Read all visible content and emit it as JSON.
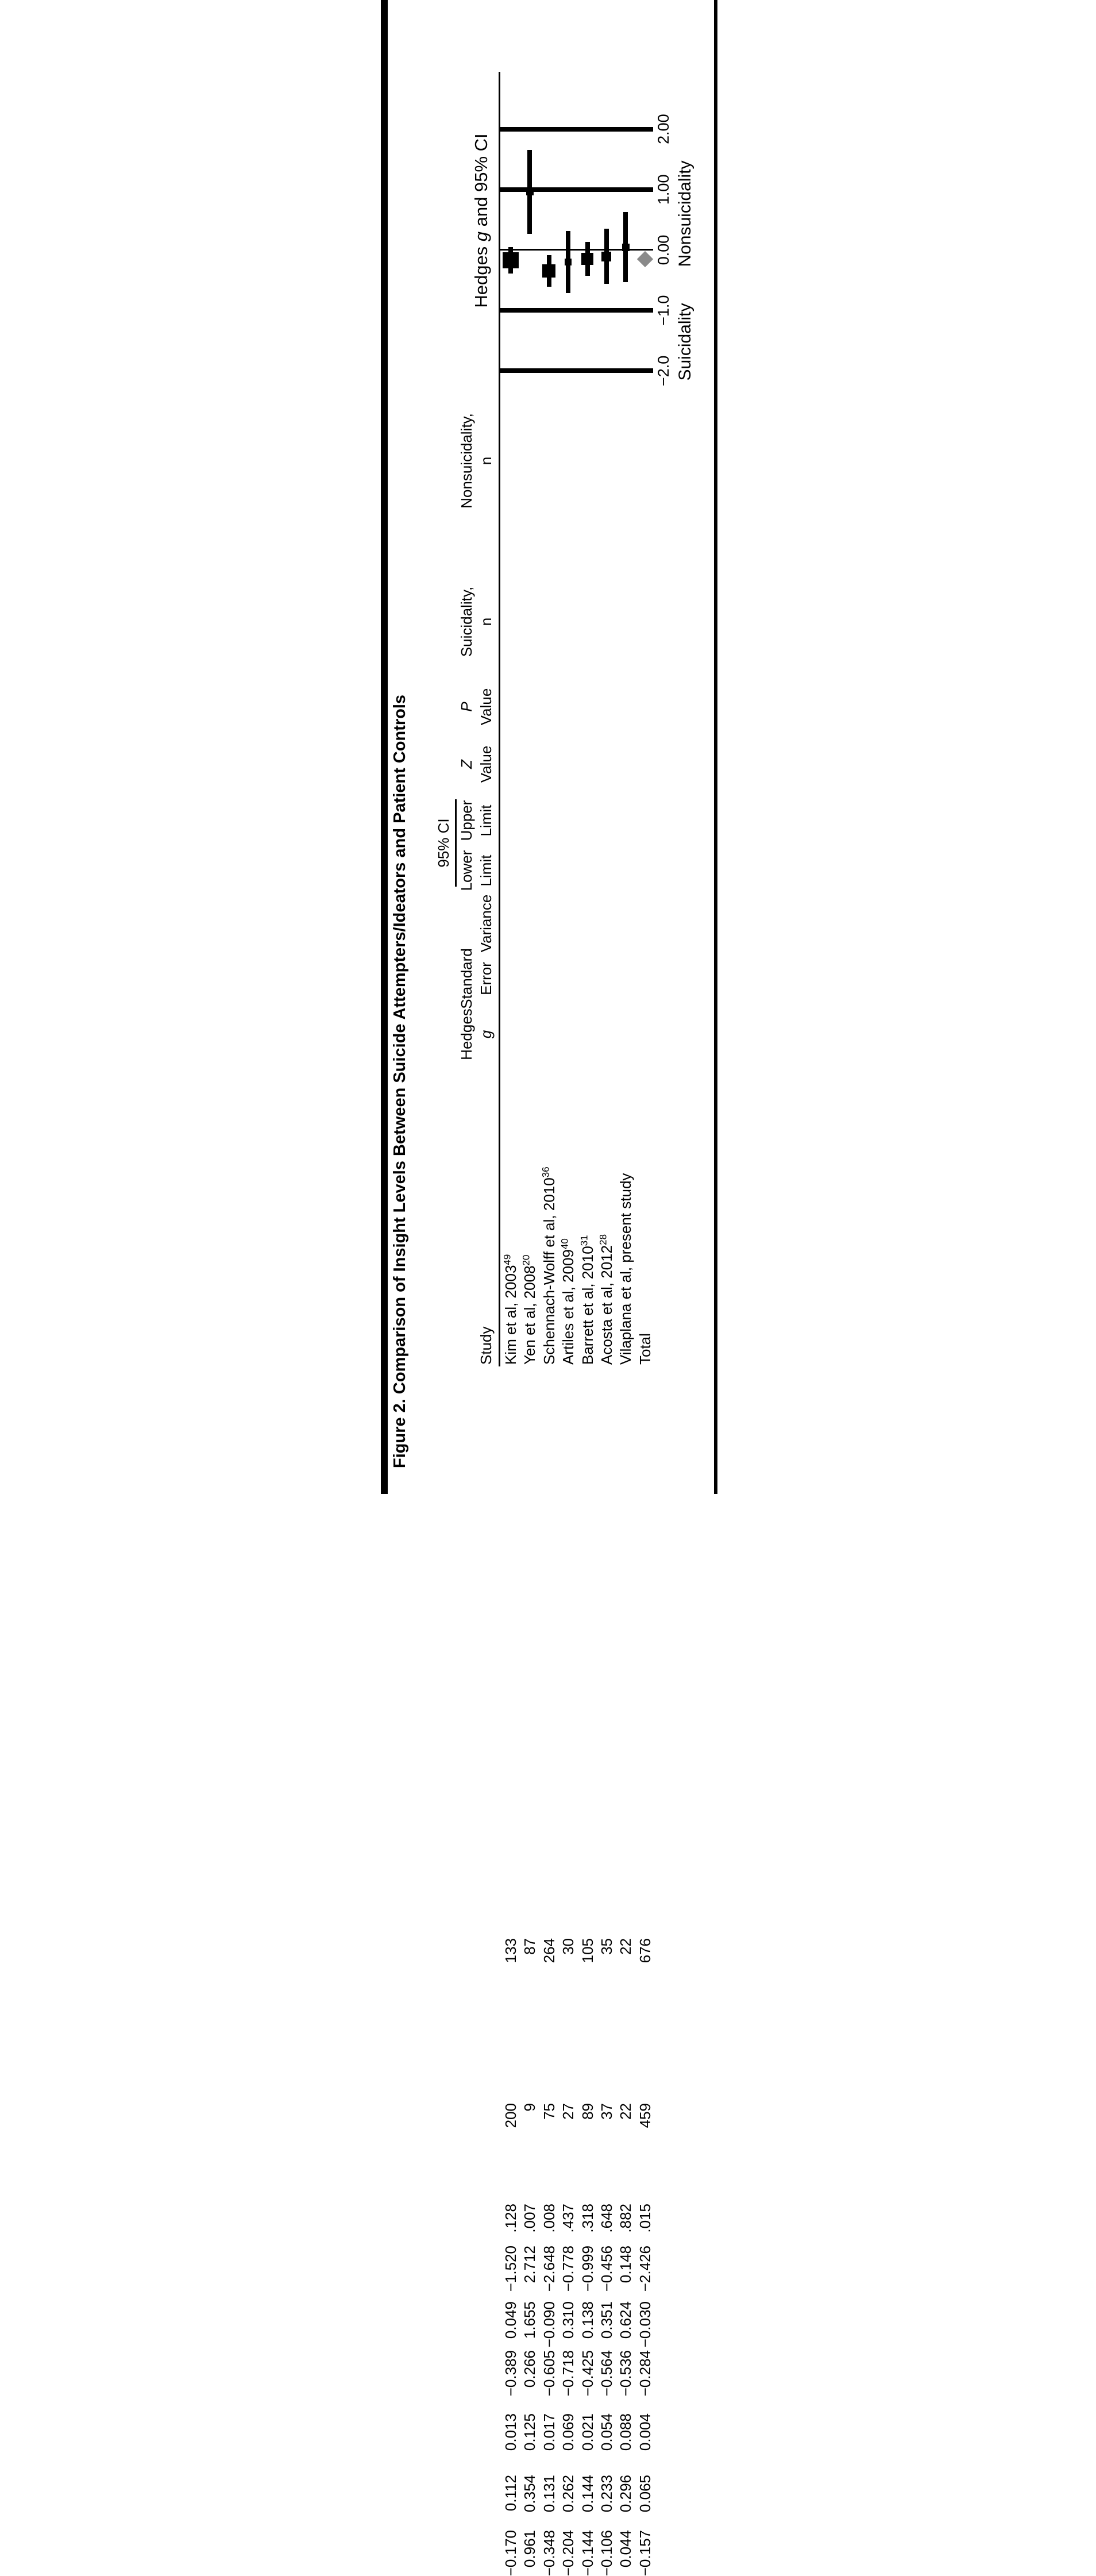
{
  "title": "Figure 2. Comparison of Insight Levels Between Suicide Attempters/Ideators and Patient Controls",
  "table": {
    "ci_spanner": "95% CI",
    "columns": [
      {
        "key": "study",
        "line1": "",
        "line2": "Study"
      },
      {
        "key": "g",
        "line1": "Hedges",
        "line2": "g"
      },
      {
        "key": "se",
        "line1": "Standard",
        "line2": "Error"
      },
      {
        "key": "variance",
        "line1": "",
        "line2": "Variance"
      },
      {
        "key": "lower",
        "line1": "Lower",
        "line2": "Limit"
      },
      {
        "key": "upper",
        "line1": "Upper",
        "line2": "Limit"
      },
      {
        "key": "z",
        "line1": "Z",
        "line2": "Value"
      },
      {
        "key": "p",
        "line1": "P",
        "line2": "Value"
      },
      {
        "key": "suic",
        "line1": "Suicidality,",
        "line2": "n"
      },
      {
        "key": "nonsuic",
        "line1": "Nonsuicidality,",
        "line2": "n"
      }
    ],
    "rows": [
      {
        "study": "Kim et al, 2003",
        "ref": "49",
        "g": "−0.170",
        "se": "0.112",
        "variance": "0.013",
        "lower": "−0.389",
        "upper": "0.049",
        "z": "−1.520",
        "p": ".128",
        "suic": "200",
        "nonsuic": "133"
      },
      {
        "study": "Yen et al, 2008",
        "ref": "20",
        "g": "0.961",
        "se": "0.354",
        "variance": "0.125",
        "lower": "0.266",
        "upper": "1.655",
        "z": "2.712",
        "p": ".007",
        "suic": "9",
        "nonsuic": "87"
      },
      {
        "study": "Schennach-Wolff et al, 2010",
        "ref": "36",
        "g": "−0.348",
        "se": "0.131",
        "variance": "0.017",
        "lower": "−0.605",
        "upper": "−0.090",
        "z": "−2.648",
        "p": ".008",
        "suic": "75",
        "nonsuic": "264"
      },
      {
        "study": "Artiles et al, 2009",
        "ref": "40",
        "g": "−0.204",
        "se": "0.262",
        "variance": "0.069",
        "lower": "−0.718",
        "upper": "0.310",
        "z": "−0.778",
        "p": ".437",
        "suic": "27",
        "nonsuic": "30"
      },
      {
        "study": "Barrett et al, 2010",
        "ref": "31",
        "g": "−0.144",
        "se": "0.144",
        "variance": "0.021",
        "lower": "−0.425",
        "upper": "0.138",
        "z": "−0.999",
        "p": ".318",
        "suic": "89",
        "nonsuic": "105"
      },
      {
        "study": "Acosta et al, 2012",
        "ref": "28",
        "g": "−0.106",
        "se": "0.233",
        "variance": "0.054",
        "lower": "−0.564",
        "upper": "0.351",
        "z": "−0.456",
        "p": ".648",
        "suic": "37",
        "nonsuic": "35"
      },
      {
        "study": "Vilaplana et al, present study",
        "ref": "",
        "g": "0.044",
        "se": "0.296",
        "variance": "0.088",
        "lower": "−0.536",
        "upper": "0.624",
        "z": "0.148",
        "p": ".882",
        "suic": "22",
        "nonsuic": "22"
      },
      {
        "study": "Total",
        "ref": "",
        "g": "−0.157",
        "se": "0.065",
        "variance": "0.004",
        "lower": "−0.284",
        "upper": "−0.030",
        "z": "−2.426",
        "p": ".015",
        "suic": "459",
        "nonsuic": "676"
      }
    ]
  },
  "plot": {
    "header_parts": [
      "Hedges ",
      "g",
      " and 95% CI"
    ],
    "tick_labels": [
      "−2.0",
      "−1.0",
      "0.00",
      "1.00",
      "2.00"
    ],
    "axis_label_left": "Suicidality",
    "axis_label_right": "Nonsuicidality",
    "marker_color": "#000000",
    "diamond_color": "#8a8a8a"
  },
  "chart_data": {
    "type": "scatter",
    "subtype": "forest-plot",
    "title": "Hedges g and 95% CI",
    "xlabel": "Hedges g",
    "xlim": [
      -2,
      2
    ],
    "xticks": [
      -2,
      -1,
      0,
      1,
      2
    ],
    "xtick_labels": [
      "−2.0",
      "−1.0",
      "0.00",
      "1.00",
      "2.00"
    ],
    "direction_labels": {
      "negative": "Suicidality",
      "positive": "Nonsuicidality"
    },
    "grid": "vertical lines at ±1 and ±2, thin line at 0",
    "studies": [
      {
        "name": "Kim et al, 2003",
        "ref": 49,
        "g": -0.17,
        "lower": -0.389,
        "upper": 0.049,
        "marker_size": 28
      },
      {
        "name": "Yen et al, 2008",
        "ref": 20,
        "g": 0.961,
        "lower": 0.266,
        "upper": 1.655,
        "marker_size": 13
      },
      {
        "name": "Schennach-Wolff et al, 2010",
        "ref": 36,
        "g": -0.348,
        "lower": -0.605,
        "upper": -0.09,
        "marker_size": 23
      },
      {
        "name": "Artiles et al, 2009",
        "ref": 40,
        "g": -0.204,
        "lower": -0.718,
        "upper": 0.31,
        "marker_size": 12
      },
      {
        "name": "Barrett et al, 2010",
        "ref": 31,
        "g": -0.144,
        "lower": -0.425,
        "upper": 0.138,
        "marker_size": 21
      },
      {
        "name": "Acosta et al, 2012",
        "ref": 28,
        "g": -0.106,
        "lower": -0.564,
        "upper": 0.351,
        "marker_size": 17
      },
      {
        "name": "Vilaplana et al, present study",
        "ref": null,
        "g": 0.044,
        "lower": -0.536,
        "upper": 0.624,
        "marker_size": 13
      }
    ],
    "total": {
      "name": "Total",
      "g": -0.157,
      "lower": -0.284,
      "upper": -0.03,
      "marker": "gray diamond"
    }
  }
}
